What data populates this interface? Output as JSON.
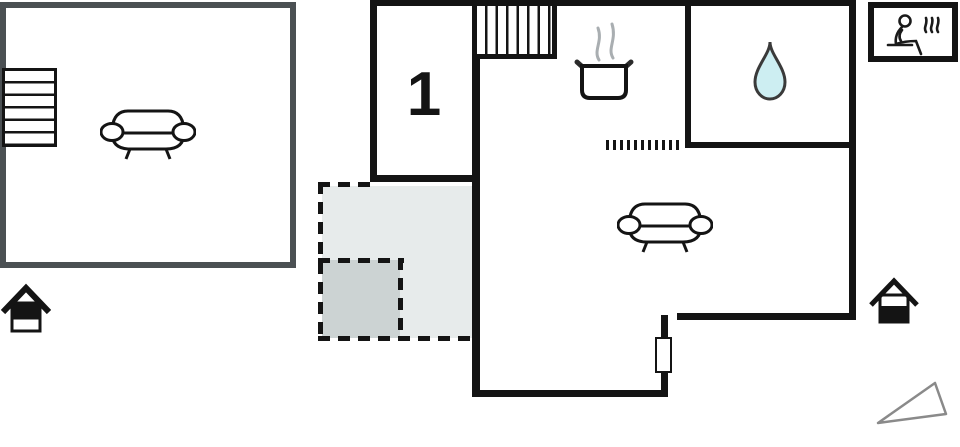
{
  "title": "holiday-home floor plan",
  "plan": {
    "room_label": "1",
    "floors": {
      "upper_floor": "left outlined room with stairs and sofa",
      "ground_floor": "right plan with kitchen, bathroom, living room, hallway and terrace"
    }
  },
  "icons": {
    "upper_stairs": "stairs",
    "main_stairs": "stairs",
    "sofa_upper": "sofa",
    "sofa_living_room": "sofa",
    "cooking_pot": "cooking-pot-with-steam",
    "water_drop": "water-drop",
    "sauna": "person-in-sauna",
    "house_upper_floor": "house-top-half-filled",
    "house_ground_floor": "house-bottom-half-filled",
    "direction_triangle": "triangle-pointer",
    "window_marker": "window",
    "dotted_partition": "counter-divider"
  },
  "colors": {
    "wall": "#141414",
    "upper_floor_outline": "#4b5053",
    "terrace_light": "#e7ebeb",
    "terrace_dark": "#ccd3d3",
    "water_drop_fill": "#cdeef2",
    "steam_gray": "#a9aeb1",
    "triangle_stroke": "#8a8a8a",
    "background": "#ffffff"
  }
}
